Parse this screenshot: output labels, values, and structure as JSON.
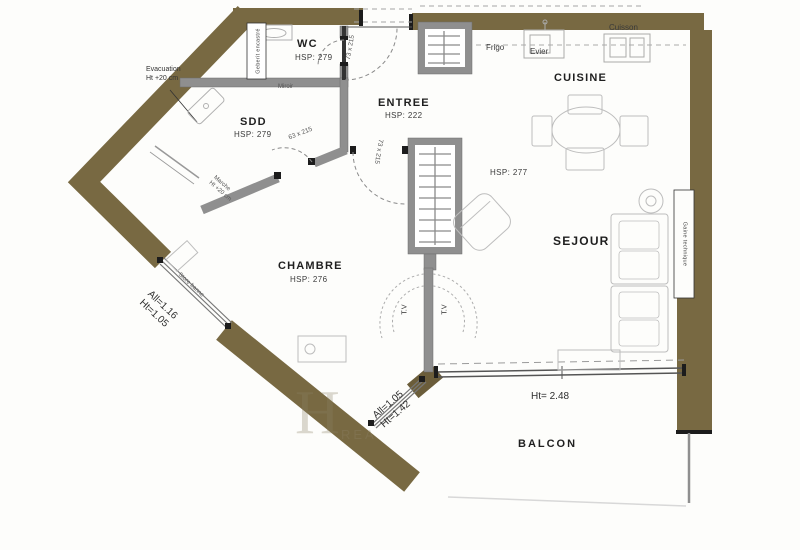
{
  "palette": {
    "exterior_wall": "#786942",
    "partition": "#8f8f8f",
    "window_line": "#777777",
    "sketch": "#bdbdbd"
  },
  "rooms": {
    "wc": {
      "label": "WC",
      "hsp": "HSP: 279"
    },
    "sdd": {
      "label": "SDD",
      "hsp": "HSP: 279"
    },
    "entree": {
      "label": "ENTREE",
      "hsp": "HSP: 222"
    },
    "cuisine": {
      "label": "CUISINE",
      "hsp": "HSP: 277"
    },
    "sejour": {
      "label": "SEJOUR"
    },
    "chambre": {
      "label": "CHAMBRE",
      "hsp": "HSP: 276"
    },
    "balcon": {
      "label": "BALCON"
    }
  },
  "kitchen": {
    "frigo": "Frigo",
    "evier": "Evier",
    "cuisson": "Cuisson"
  },
  "doors": {
    "entry": "73 x 215",
    "hall": "73 x 215",
    "sdd": "63 x 215"
  },
  "windows": {
    "west": {
      "line1": "All=1.16",
      "line2": "Ht=1.05",
      "note": "Store banne"
    },
    "south": {
      "line1": "All=1.05",
      "line2": "Ht=1.42"
    },
    "bay": {
      "height": "Ht= 2.48"
    }
  },
  "annotations": {
    "evacuation_line1": "Evacuation",
    "evacuation_line2": "Ht +20 cm",
    "marche_line1": "Marche",
    "marche_line2": "Ht +20 cm",
    "miroir": "Miroir",
    "geberit": "Geberit encastré",
    "gaine": "Gaine technique",
    "tv": "T.V"
  },
  "watermark": {
    "letter": "H",
    "text": "REA"
  }
}
